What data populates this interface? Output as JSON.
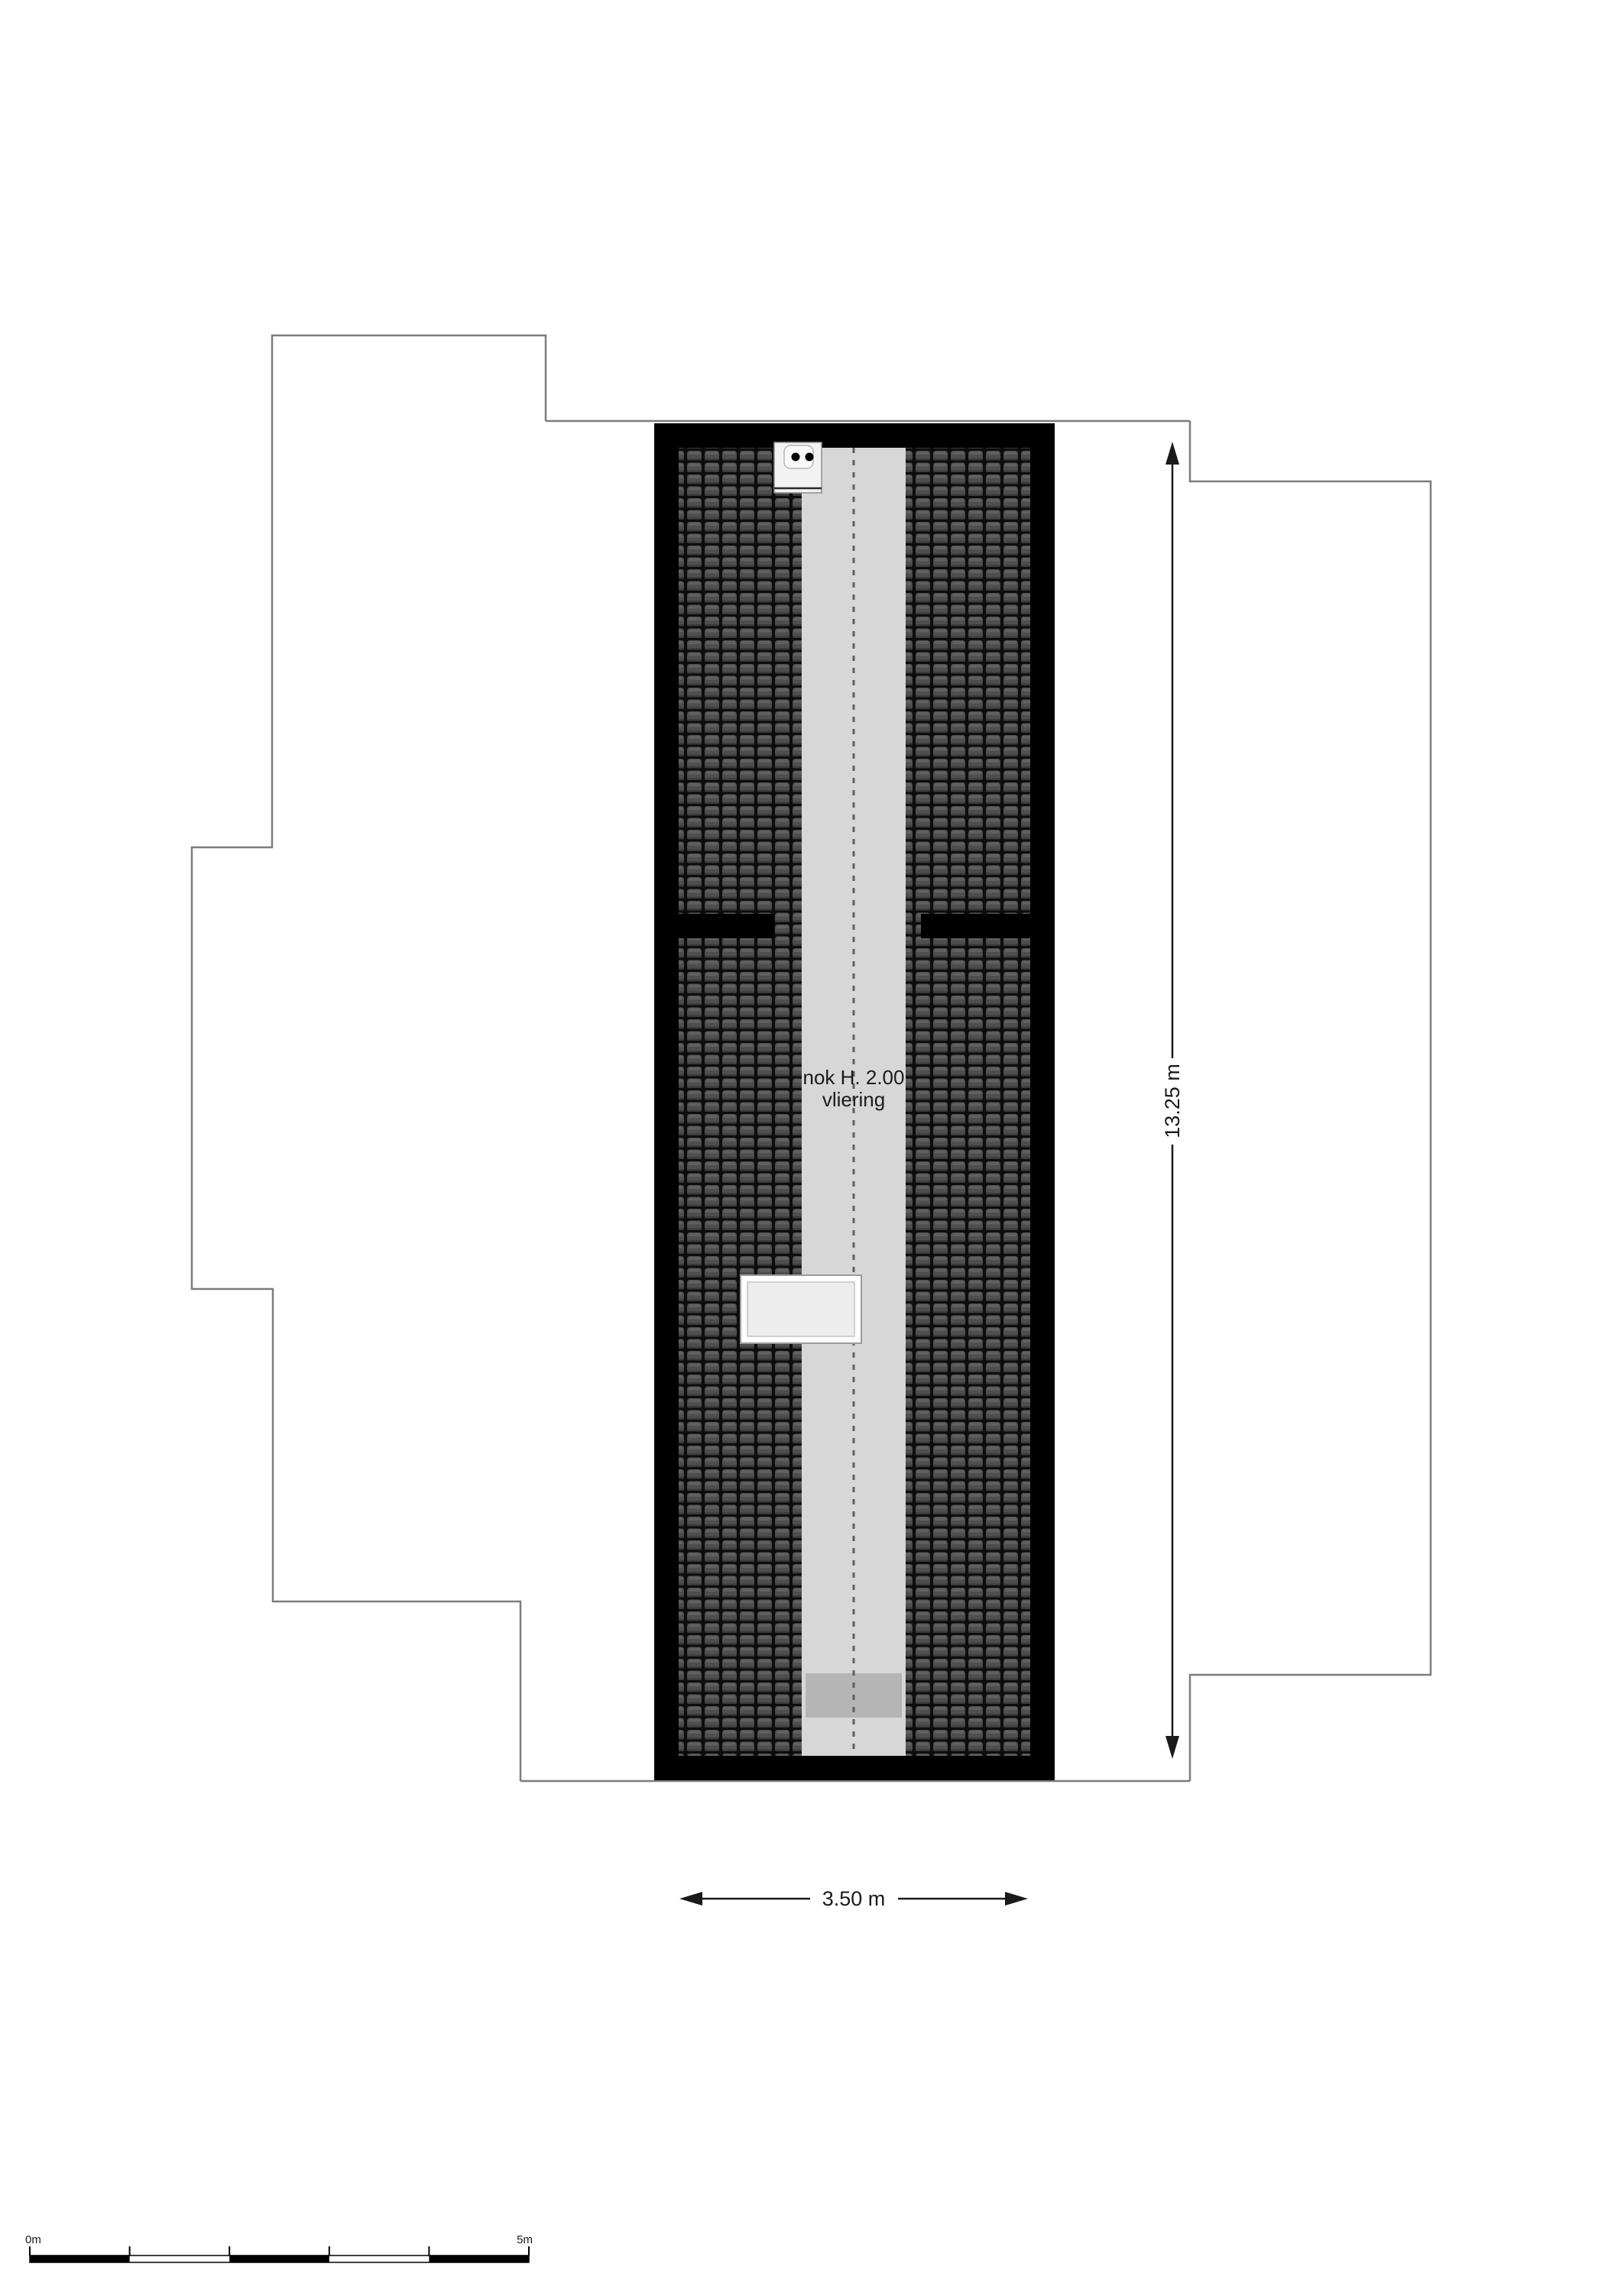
{
  "plan": {
    "room_label_line1": "nok H. 2.00",
    "room_label_line2": "vliering",
    "dim_vertical_label": "13.25 m",
    "dim_horizontal_label": "3.50 m"
  },
  "scale_bar": {
    "start_label": "0m",
    "end_label": "5m"
  },
  "colors": {
    "wall": "#000000",
    "roof_tile": "#4e4e4e",
    "roof_joint": "#0d0d0d",
    "ridge_strip": "#d7d7d7",
    "stair_band": "#b5b5b5",
    "outline": "#7d7d7d",
    "dimension": "#1a1a1a",
    "skylight_fill": "#ededed",
    "vent_fill": "#f2f2f2"
  }
}
